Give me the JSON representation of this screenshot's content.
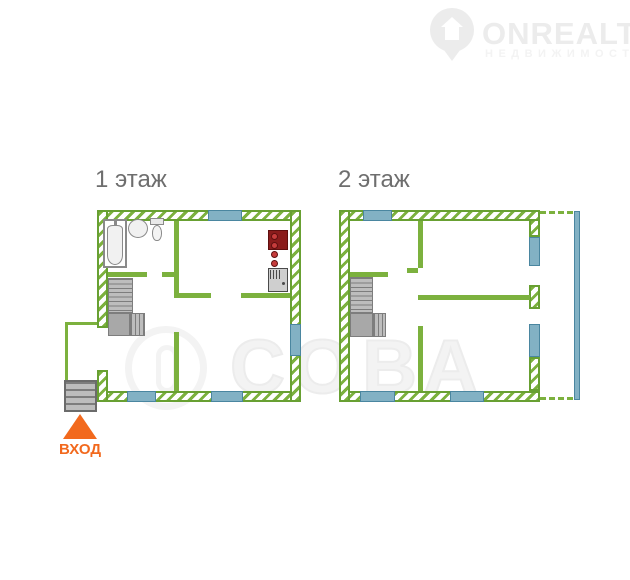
{
  "watermark_logo": {
    "name": "ONREALT",
    "subtitle": "НЕДВИЖИМОСТЬ",
    "icon": "house-pin-icon"
  },
  "watermark_center": {
    "text": "СОВА",
    "icon": "owl-icon"
  },
  "floors": [
    {
      "label": "1 этаж",
      "fixtures": [
        "bathtub",
        "washbasin",
        "toilet",
        "staircase",
        "stove",
        "kitchen-sink",
        "entrance-steps",
        "porch"
      ],
      "window_count": 4
    },
    {
      "label": "2 этаж",
      "fixtures": [
        "staircase",
        "balcony-glazing"
      ],
      "window_count": 6
    }
  ],
  "entrance": {
    "label": "ВХОД",
    "arrow": "up-triangle"
  },
  "colors": {
    "wall_green": "#7cb13e",
    "wall_green_dark": "#68a032",
    "window_fill": "#82b1c4",
    "window_border": "#4a86a0",
    "stair_fill": "#bdbdbd",
    "stair_line": "#7d7d7d",
    "stair_landing": "#a8a8a8",
    "fixture_gray": "#8a8a8a",
    "stove_body": "#8a1c1c",
    "stove_burner": "#c63c3c",
    "appliance_gray": "#cfcfcf",
    "appliance_dark": "#4a4a4a",
    "label_gray": "#6e6e6e",
    "entrance_orange": "#f2691d",
    "watermark_gray": "#ececec",
    "watermark_gray2": "#f3f3f3"
  }
}
